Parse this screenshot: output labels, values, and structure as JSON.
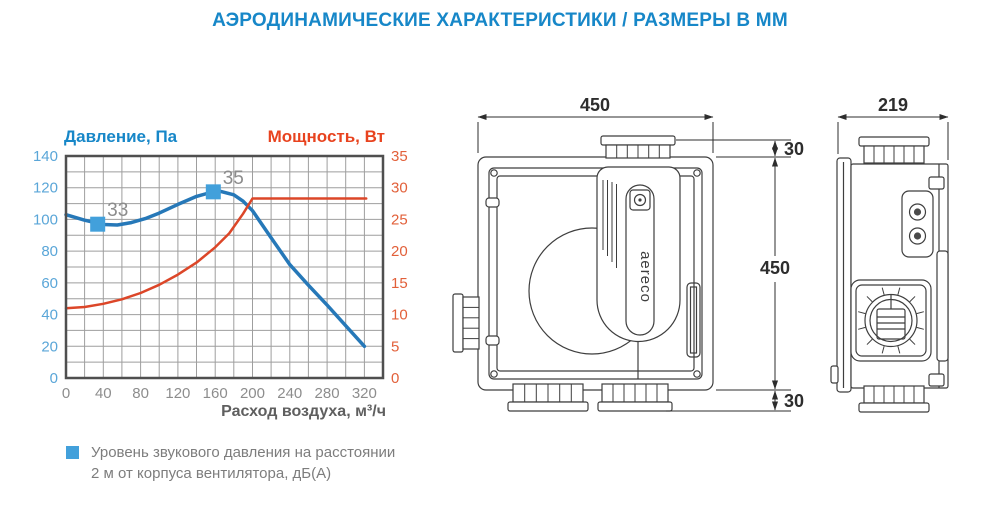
{
  "header": {
    "title": "АЭРОДИНАМИЧЕСКИЕ ХАРАКТЕРИСТИКИ / РАЗМЕРЫ В ММ",
    "color": "#1787c8"
  },
  "chart_data": {
    "type": "line",
    "xlabel": "Расход воздуха, м³/ч",
    "x_label_color": "#5f5f5f",
    "x_tick_color": "#8d8d8d",
    "x_range": [
      0,
      340
    ],
    "x_grid_step": 20,
    "x_ticks": [
      0,
      40,
      80,
      120,
      160,
      200,
      240,
      280,
      320
    ],
    "grid_color": "#9e9e9e",
    "frame_color": "#4f4f4f",
    "left_axis": {
      "label": "Давление, Па",
      "range": [
        0,
        140
      ],
      "grid_step": 10,
      "ticks": [
        0,
        20,
        40,
        60,
        80,
        100,
        120,
        140
      ],
      "title_color": "#1787c8",
      "tick_color": "#5aa6d8"
    },
    "right_axis": {
      "label": "Мощность, Вт",
      "range": [
        0,
        35
      ],
      "ticks": [
        0,
        5,
        10,
        15,
        20,
        25,
        30,
        35
      ],
      "title_color": "#e8431f",
      "tick_color": "#e2603a"
    },
    "series": [
      {
        "name": "Давление (Па)",
        "axis": "left",
        "color": "#2678b8",
        "width": 3.5,
        "points": [
          [
            0,
            103
          ],
          [
            20,
            99.5
          ],
          [
            40,
            96.8
          ],
          [
            55,
            96.5
          ],
          [
            70,
            98
          ],
          [
            85,
            100.5
          ],
          [
            100,
            104
          ],
          [
            120,
            109.5
          ],
          [
            140,
            114.5
          ],
          [
            155,
            117
          ],
          [
            165,
            117.8
          ],
          [
            180,
            115.5
          ],
          [
            190,
            111.5
          ],
          [
            200,
            105.5
          ],
          [
            220,
            88.5
          ],
          [
            240,
            71.5
          ],
          [
            260,
            58.5
          ],
          [
            280,
            46
          ],
          [
            300,
            33
          ],
          [
            320,
            20
          ]
        ]
      },
      {
        "name": "Мощность (Вт)",
        "axis": "right",
        "color": "#dc4628",
        "width": 2.5,
        "points": [
          [
            0,
            11
          ],
          [
            20,
            11.2
          ],
          [
            40,
            11.7
          ],
          [
            60,
            12.4
          ],
          [
            80,
            13.4
          ],
          [
            100,
            14.7
          ],
          [
            120,
            16.3
          ],
          [
            140,
            18.2
          ],
          [
            160,
            20.6
          ],
          [
            175,
            22.8
          ],
          [
            190,
            25.9
          ],
          [
            200,
            28.3
          ],
          [
            322,
            28.3
          ]
        ]
      }
    ],
    "markers": [
      {
        "x": 34,
        "y": 97,
        "label": "33"
      },
      {
        "x": 158,
        "y": 117.4,
        "label": "35"
      }
    ],
    "marker_color": "#42a0db",
    "legend": {
      "line1": "Уровень звукового давления на расстоянии",
      "line2": "2 м от корпуса вентилятора, дБ(А)"
    }
  },
  "drawings": {
    "front_view": {
      "dim_width": "450",
      "dim_height": "450",
      "dim_top_offset": "30",
      "dim_bottom_offset": "30",
      "logo": "aereco"
    },
    "side_view": {
      "dim_depth": "219"
    }
  }
}
